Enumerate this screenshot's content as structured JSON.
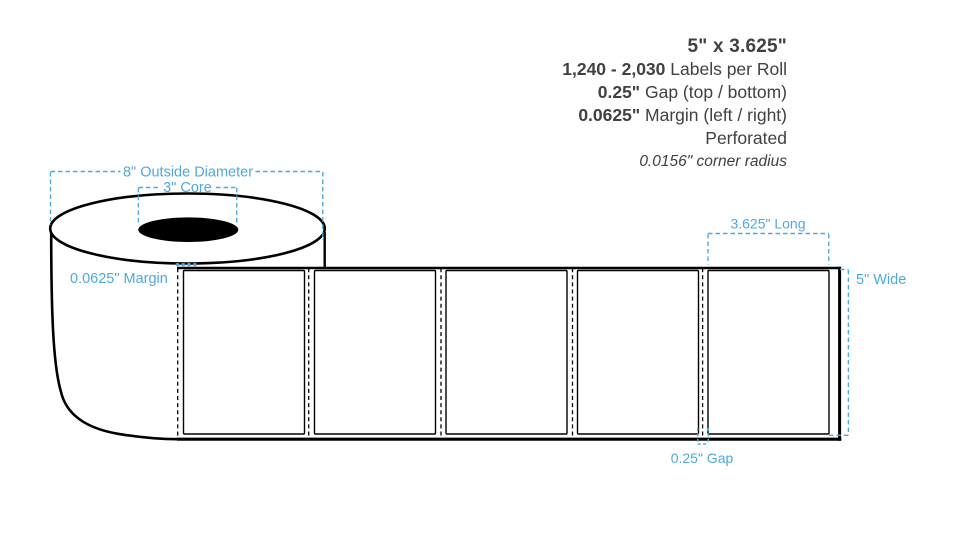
{
  "spec_block": {
    "size": "5\" x 3.625\"",
    "rows": [
      {
        "value": "1,240 - 2,030",
        "label": "Labels per Roll"
      },
      {
        "value": "0.25\"",
        "label": "Gap (top / bottom)"
      },
      {
        "value": "0.0625\"",
        "label": "Margin (left / right)"
      }
    ],
    "finish": "Perforated",
    "corner_radius": "0.0156\" corner radius"
  },
  "annotations": {
    "outside_diameter": "8\" Outside Diameter",
    "core": "3\" Core",
    "margin": "0.0625\" Margin",
    "label_length": "3.625\" Long",
    "roll_width": "5\" Wide",
    "gap": "0.25\" Gap"
  },
  "diagram": {
    "label_count": 5,
    "colors": {
      "annotation_blue": "#4FA8DF",
      "spec_text": "#414042",
      "outline": "#000000",
      "background": "#FFFFFF"
    }
  }
}
